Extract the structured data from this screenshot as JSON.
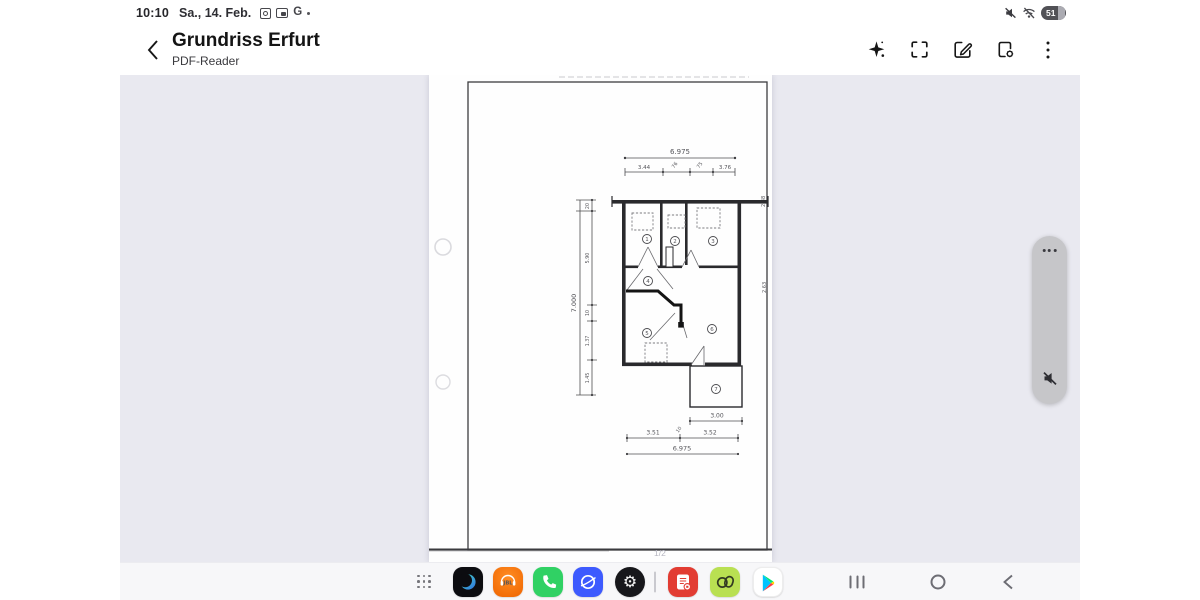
{
  "colors": {
    "viewer_bg": "#e9e9f0",
    "taskbar_bg": "#f7f7f9",
    "panel_bg": "#c6c6c9",
    "accent_jbl": "#ef6400",
    "accent_phone": "#30d164",
    "accent_internet": "#3d5afe",
    "accent_pdf_app": "#e23c32",
    "accent_lime_app": "#b9e052"
  },
  "status_bar": {
    "time": "10:10",
    "date": "Sa., 14. Feb.",
    "google_glyph": "G",
    "battery_percent": "51",
    "left_icons": [
      "screen-capture-icon",
      "pip-icon",
      "google-g-icon",
      "overflow-dot-icon"
    ],
    "right_icons": [
      "volume-muted-icon",
      "wifi-off-icon",
      "battery-indicator"
    ]
  },
  "header": {
    "title": "Grundriss Erfurt",
    "subtitle": "PDF-Reader",
    "actions": [
      {
        "name": "ai-assist"
      },
      {
        "name": "fullscreen"
      },
      {
        "name": "edit-annotate"
      },
      {
        "name": "document-settings"
      },
      {
        "name": "more-menu"
      }
    ]
  },
  "viewer": {
    "page_indicator": "1/2"
  },
  "floorplan": {
    "dim_top_total": "6.975",
    "dim_top_segments": [
      "3.44",
      "76",
      "75",
      "3.76"
    ],
    "dim_left_total": "7.000",
    "dim_left_segments": [
      "20",
      "5.90",
      "10",
      "1.37",
      "1.45"
    ],
    "dim_right_upper": "2.38",
    "dim_right_lower": "2.63",
    "dim_bottom_short": "3.00",
    "dim_bottom_mid_left": "3.51",
    "dim_bottom_mid_small": "10",
    "dim_bottom_mid_right": "3.52",
    "dim_bottom_total": "6.975",
    "rooms": [
      "1",
      "2",
      "3",
      "4",
      "5",
      "6",
      "7"
    ]
  },
  "taskbar": {
    "jbl_label": "JBL",
    "apps": [
      "app-drawer",
      "modes-app",
      "jbl-app",
      "phone-app",
      "internet-app",
      "settings-app",
      "pdf-reader-app",
      "notes-app",
      "play-store-app"
    ],
    "nav": [
      "recents",
      "home",
      "back"
    ]
  }
}
